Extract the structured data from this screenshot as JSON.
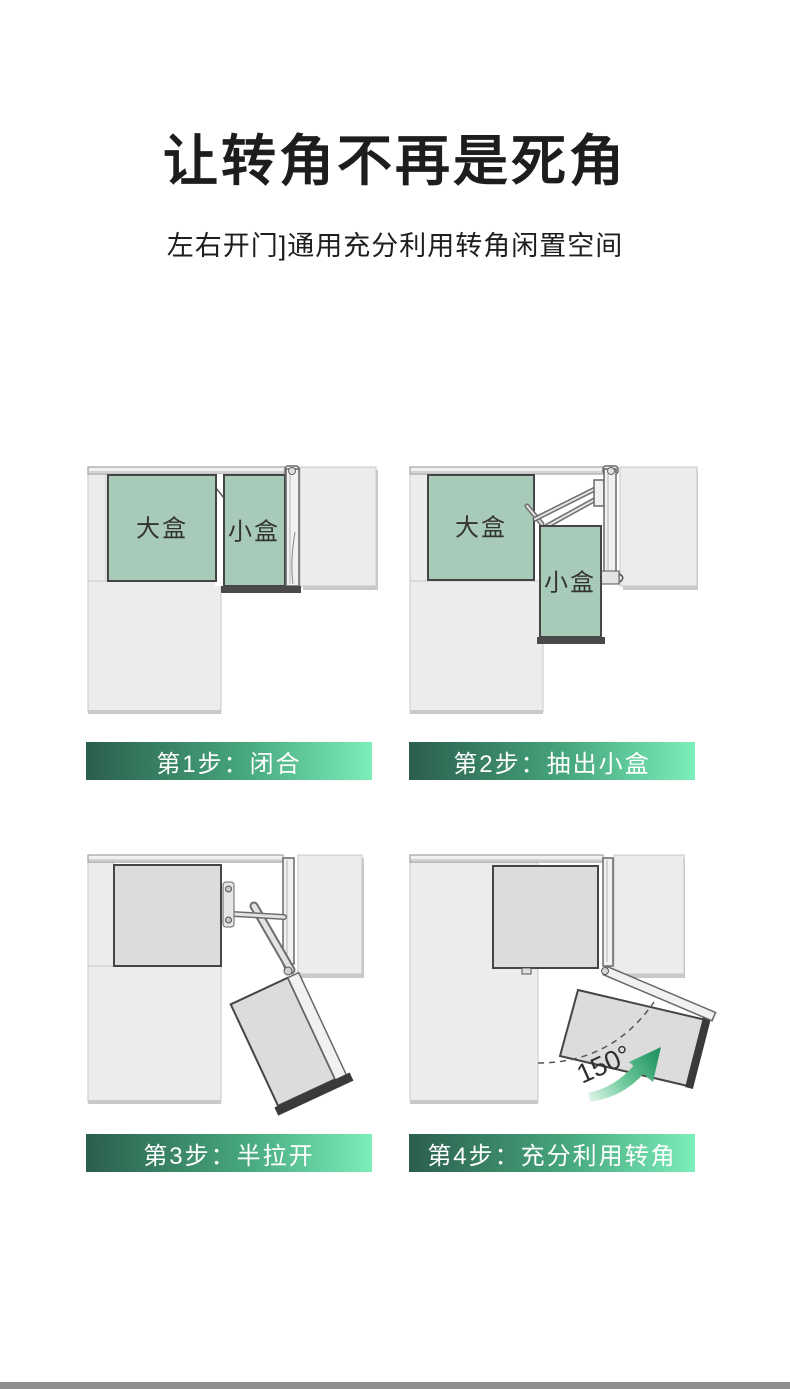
{
  "header": {
    "title": "让转角不再是死角",
    "subtitle": "左右开门]通用充分利用转角闲置空间"
  },
  "panels": [
    {
      "step": "第1步：闭合",
      "big_box_label": "大盒",
      "small_box_label": "小盒"
    },
    {
      "step": "第2步：抽出小盒",
      "big_box_label": "大盒",
      "small_box_label": "小盒"
    },
    {
      "step": "第3步：半拉开"
    },
    {
      "step": "第4步：充分利用转角",
      "angle_label": "150°"
    }
  ],
  "colors": {
    "box_green": "#a8cab8",
    "box_gray": "#dcdcdc",
    "cabinet_gray": "#ececec",
    "box_outline": "#454545",
    "threshold_dark": "#4a4a4a",
    "label_gradient_start": "#2b5e4d",
    "label_gradient_end": "#7cefba",
    "arrow_green": "#1e8f5e",
    "bottom_bar": "#8d8d8d"
  }
}
